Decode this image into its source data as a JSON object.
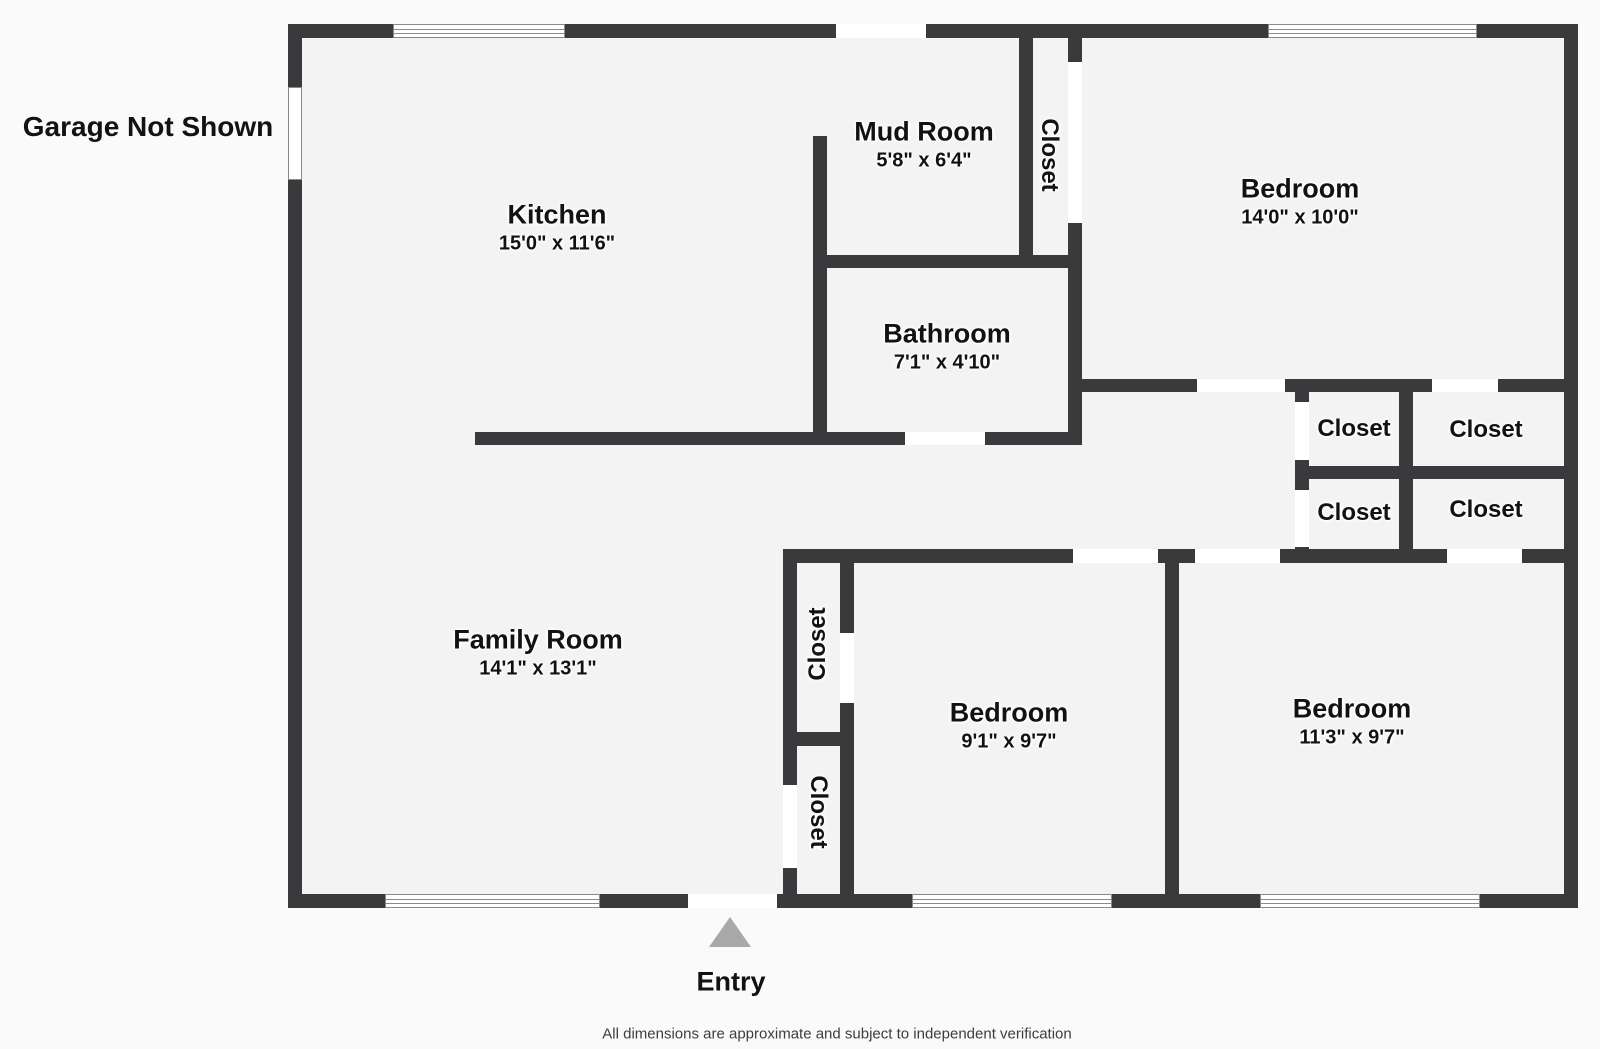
{
  "annotations": {
    "garage_note": "Garage Not Shown",
    "entry_label": "Entry",
    "disclaimer": "All dimensions are approximate and subject to independent verification"
  },
  "colors": {
    "wall": "#3a3a3c",
    "floor": "#f3f3f3",
    "window": "#ffffff",
    "window_line": "#8a8a8a",
    "text": "#121212",
    "entry_arrow": "#a9a9a9",
    "background": "#fafafa"
  },
  "plan": {
    "floor": [
      302,
      38,
      1262,
      856
    ],
    "rooms": [
      {
        "id": "kitchen",
        "name": "Kitchen",
        "dims": "15'0\" x 11'6\"",
        "cx": 557,
        "cy": 228,
        "rot": 0
      },
      {
        "id": "mud-room",
        "name": "Mud Room",
        "dims": "5'8\" x 6'4\"",
        "cx": 924,
        "cy": 145,
        "rot": 0
      },
      {
        "id": "bathroom",
        "name": "Bathroom",
        "dims": "7'1\" x 4'10\"",
        "cx": 947,
        "cy": 347,
        "rot": 0
      },
      {
        "id": "bedroom-1",
        "name": "Bedroom",
        "dims": "14'0\" x 10'0\"",
        "cx": 1300,
        "cy": 202,
        "rot": 0
      },
      {
        "id": "family-room",
        "name": "Family Room",
        "dims": "14'1\" x 13'1\"",
        "cx": 538,
        "cy": 653,
        "rot": 0
      },
      {
        "id": "bedroom-2",
        "name": "Bedroom",
        "dims": "9'1\" x 9'7\"",
        "cx": 1009,
        "cy": 726,
        "rot": 0
      },
      {
        "id": "bedroom-3",
        "name": "Bedroom",
        "dims": "11'3\" x 9'7\"",
        "cx": 1352,
        "cy": 722,
        "rot": 0
      },
      {
        "id": "closet-mudroom",
        "name": "Closet",
        "dims": "",
        "cx": 1049,
        "cy": 155,
        "rot": 90
      },
      {
        "id": "closet-upper-left",
        "name": "Closet",
        "dims": "",
        "cx": 1354,
        "cy": 429,
        "rot": 0
      },
      {
        "id": "closet-upper-right",
        "name": "Closet",
        "dims": "",
        "cx": 1486,
        "cy": 430,
        "rot": 0
      },
      {
        "id": "closet-lower-left",
        "name": "Closet",
        "dims": "",
        "cx": 1354,
        "cy": 513,
        "rot": 0
      },
      {
        "id": "closet-lower-right",
        "name": "Closet",
        "dims": "",
        "cx": 1486,
        "cy": 510,
        "rot": 0
      },
      {
        "id": "closet-hall-top",
        "name": "Closet",
        "dims": "",
        "cx": 818,
        "cy": 644,
        "rot": -90
      },
      {
        "id": "closet-hall-bottom",
        "name": "Closet",
        "dims": "",
        "cx": 818,
        "cy": 812,
        "rot": 90
      }
    ],
    "walls": [
      [
        288,
        24,
        1290,
        14
      ],
      [
        288,
        894,
        1290,
        14
      ],
      [
        288,
        38,
        14,
        856
      ],
      [
        1564,
        38,
        14,
        856
      ],
      [
        813,
        136,
        14,
        309
      ],
      [
        1019,
        38,
        14,
        230
      ],
      [
        813,
        255,
        269,
        13
      ],
      [
        1068,
        38,
        14,
        28
      ],
      [
        1068,
        223,
        14,
        222
      ],
      [
        475,
        432,
        607,
        13
      ],
      [
        1068,
        379,
        510,
        13
      ],
      [
        1295,
        466,
        283,
        13
      ],
      [
        1295,
        379,
        14,
        183
      ],
      [
        1399,
        379,
        14,
        183
      ],
      [
        783,
        549,
        795,
        14
      ],
      [
        783,
        549,
        14,
        359
      ],
      [
        840,
        549,
        14,
        359
      ],
      [
        783,
        732,
        71,
        14
      ],
      [
        1165,
        549,
        14,
        359
      ]
    ],
    "openings": [
      [
        836,
        24,
        90,
        14
      ],
      [
        1068,
        62,
        14,
        161
      ],
      [
        905,
        432,
        80,
        13
      ],
      [
        1197,
        379,
        88,
        13
      ],
      [
        1432,
        379,
        66,
        13
      ],
      [
        1295,
        402,
        14,
        58
      ],
      [
        1295,
        490,
        14,
        57
      ],
      [
        1073,
        549,
        85,
        14
      ],
      [
        1195,
        549,
        85,
        14
      ],
      [
        1447,
        549,
        75,
        14
      ],
      [
        840,
        633,
        14,
        70
      ],
      [
        783,
        785,
        14,
        83
      ],
      [
        688,
        894,
        89,
        14
      ]
    ],
    "windows": [
      {
        "x": 288,
        "y": 87,
        "w": 14,
        "h": 93,
        "lines": 0
      },
      {
        "x": 393,
        "y": 24,
        "w": 172,
        "h": 14,
        "lines": 2
      },
      {
        "x": 1268,
        "y": 24,
        "w": 209,
        "h": 14,
        "lines": 2
      },
      {
        "x": 385,
        "y": 894,
        "w": 215,
        "h": 14,
        "lines": 2
      },
      {
        "x": 912,
        "y": 894,
        "w": 200,
        "h": 14,
        "lines": 2
      },
      {
        "x": 1260,
        "y": 894,
        "w": 220,
        "h": 14,
        "lines": 2
      }
    ]
  }
}
